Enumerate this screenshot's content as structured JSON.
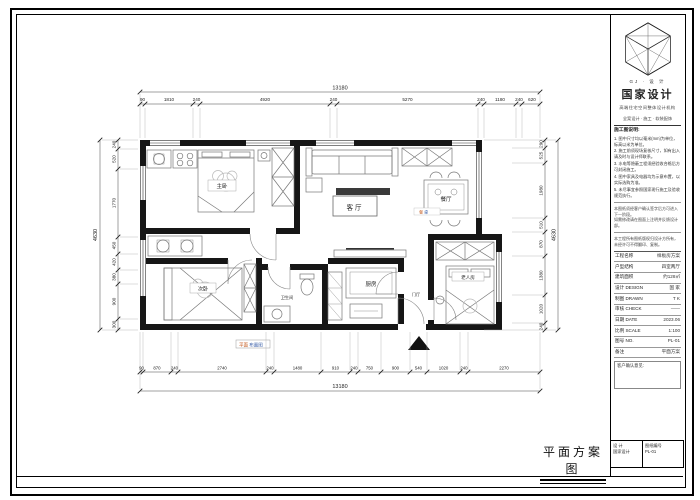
{
  "sheet": {
    "title": "平面方案图",
    "stamp": {
      "part1": "平面",
      "part2": "布置图"
    },
    "dining_stamp": {
      "part1": "餐",
      "part2": "桌"
    }
  },
  "rooms": {
    "living": "客厅",
    "dining": "餐厅",
    "master": "主卧",
    "second": "次卧",
    "elder": "老人房",
    "kitchen": "厨房",
    "bath": "卫生间",
    "entry": "门厅"
  },
  "dims": {
    "top": {
      "total": "13180",
      "values": [
        "90",
        "1810",
        "240",
        "4920",
        "240",
        "5270",
        "240",
        "1180",
        "240",
        "620"
      ]
    },
    "bottom": {
      "total": "13180",
      "values": [
        "90",
        "870",
        "240",
        "2740",
        "240",
        "1480",
        "910",
        "240",
        "750",
        "900",
        "540",
        "1020",
        "240",
        "2270"
      ]
    },
    "left": {
      "total": "4630",
      "values": [
        "240",
        "520",
        "1770",
        "450",
        "420",
        "380",
        "900",
        "300"
      ]
    },
    "right": {
      "total": "4630",
      "values": [
        "290",
        "525",
        "1980",
        "510",
        "870",
        "1380",
        "1020",
        "240"
      ]
    }
  },
  "titleblock": {
    "logo_caption": "GJ · 设 计",
    "brand": "国家设计",
    "tagline": "高端住宅空间整体设计机构",
    "contact": "全案设计 · 施工 · 软装配饰",
    "notes_title": "施工图说明:",
    "notes": [
      "1. 图中尺寸均以毫米(mm)为单位，标高以米为单位。",
      "2. 施工前须现场复核尺寸，如有出入请及时与设计师联系。",
      "3. 水电等隐蔽工程须经验收合格后方可封闭施工。",
      "4. 图中家具及电器均为示意布置，以实际选购为准。",
      "5. 未尽事宜参照国家现行施工及验收规范执行。"
    ],
    "remarks": [
      "本图纸须经客户确认签字后方可进入下一阶段。",
      "如需修改请在图面上注明并反馈设计部。"
    ],
    "copyright": "本工程所有图纸版权归设计方所有，未经许可不得翻印、复制。",
    "rows": [
      {
        "label": "工程名称",
        "value": "样板房方案"
      },
      {
        "label": "户型结构",
        "value": "四室两厅"
      },
      {
        "label": "建筑面积",
        "value": "约128㎡"
      },
      {
        "label": "设计 DESIGN",
        "value": "国 家"
      },
      {
        "label": "制图 DRAWN",
        "value": "T K"
      },
      {
        "label": "审核 CHECK",
        "value": "——"
      },
      {
        "label": "日期 DATE",
        "value": "2023.06"
      },
      {
        "label": "比例 SCALE",
        "value": "1:100"
      },
      {
        "label": "图号 NO.",
        "value": "PL-01"
      },
      {
        "label": "备注",
        "value": "平面方案"
      }
    ],
    "confirm_title": "客户确认意见:",
    "footer_cells": [
      {
        "l1": "设 计",
        "l2": "国家设计"
      },
      {
        "l1": "图纸编号",
        "l2": "PL-01"
      }
    ]
  }
}
